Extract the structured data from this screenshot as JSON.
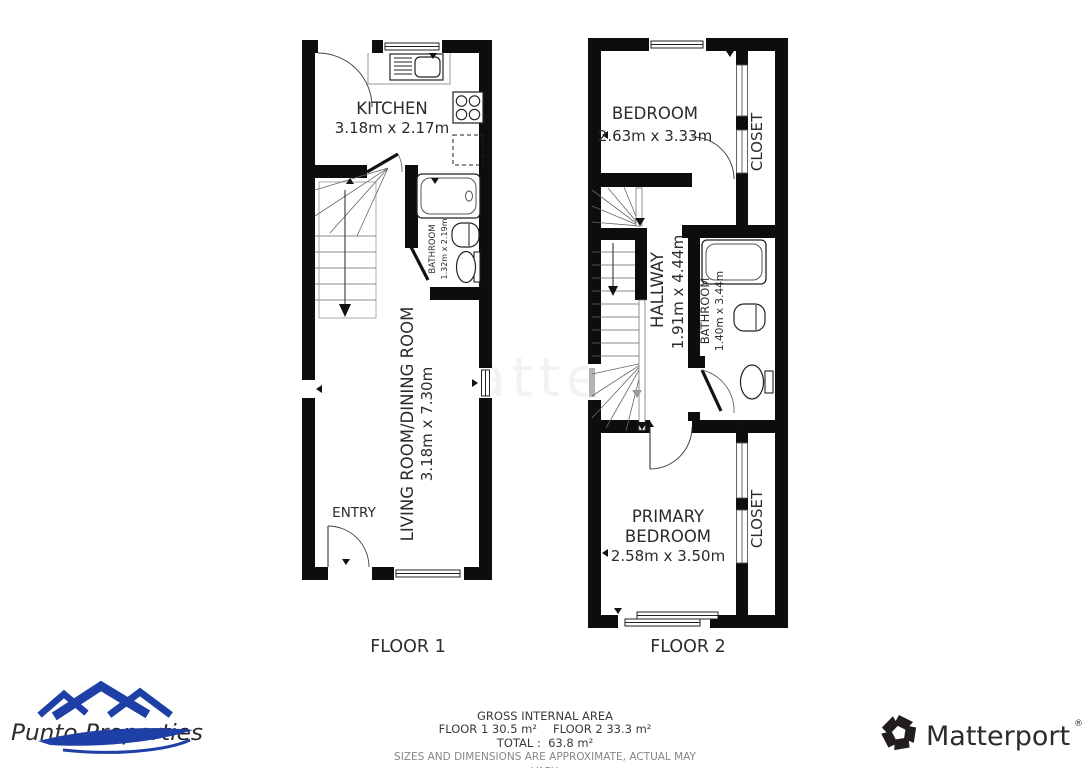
{
  "watermark": "Matterport",
  "floor1": {
    "label": "FLOOR 1",
    "rooms": {
      "kitchen": {
        "name": "KITCHEN",
        "dims": "3.18m x 2.17m"
      },
      "bathroom": {
        "name": "BATHROOM",
        "dims": "1.32m x 2.19m"
      },
      "living": {
        "name": "LIVING ROOM/DINING ROOM",
        "dims": "3.18m x 7.30m"
      },
      "entry": {
        "name": "ENTRY"
      }
    }
  },
  "floor2": {
    "label": "FLOOR 2",
    "rooms": {
      "bedroom": {
        "name": "BEDROOM",
        "dims": "2.63m x 3.33m"
      },
      "closet_top": {
        "name": "CLOSET"
      },
      "hallway": {
        "name": "HALLWAY",
        "dims": "1.91m x 4.44m"
      },
      "bathroom": {
        "name": "BATHROOM",
        "dims": "1.40m x 3.44m"
      },
      "primary_bedroom": {
        "name_lines": [
          "PRIMARY",
          "BEDROOM"
        ],
        "dims": "2.58m x 3.50m"
      },
      "closet_bottom": {
        "name": "CLOSET"
      }
    }
  },
  "summary": {
    "title": "GROSS INTERNAL AREA",
    "floor1_area": "FLOOR 1 30.5 m²",
    "floor2_area": "FLOOR 2 33.3 m²",
    "total": "TOTAL :  63.8 m²",
    "disclaimer": "SIZES AND DIMENSIONS ARE APPROXIMATE, ACTUAL MAY VARY."
  },
  "logos": {
    "punto_properties": {
      "text": "Punto Properties",
      "roof_color": "#1d3fa6",
      "text_color": "#2ab4e8"
    },
    "matterport": {
      "text": "Matterport",
      "registered": "®",
      "color": "#221e1f"
    }
  },
  "colors": {
    "walls": "#0d0d0d"
  }
}
